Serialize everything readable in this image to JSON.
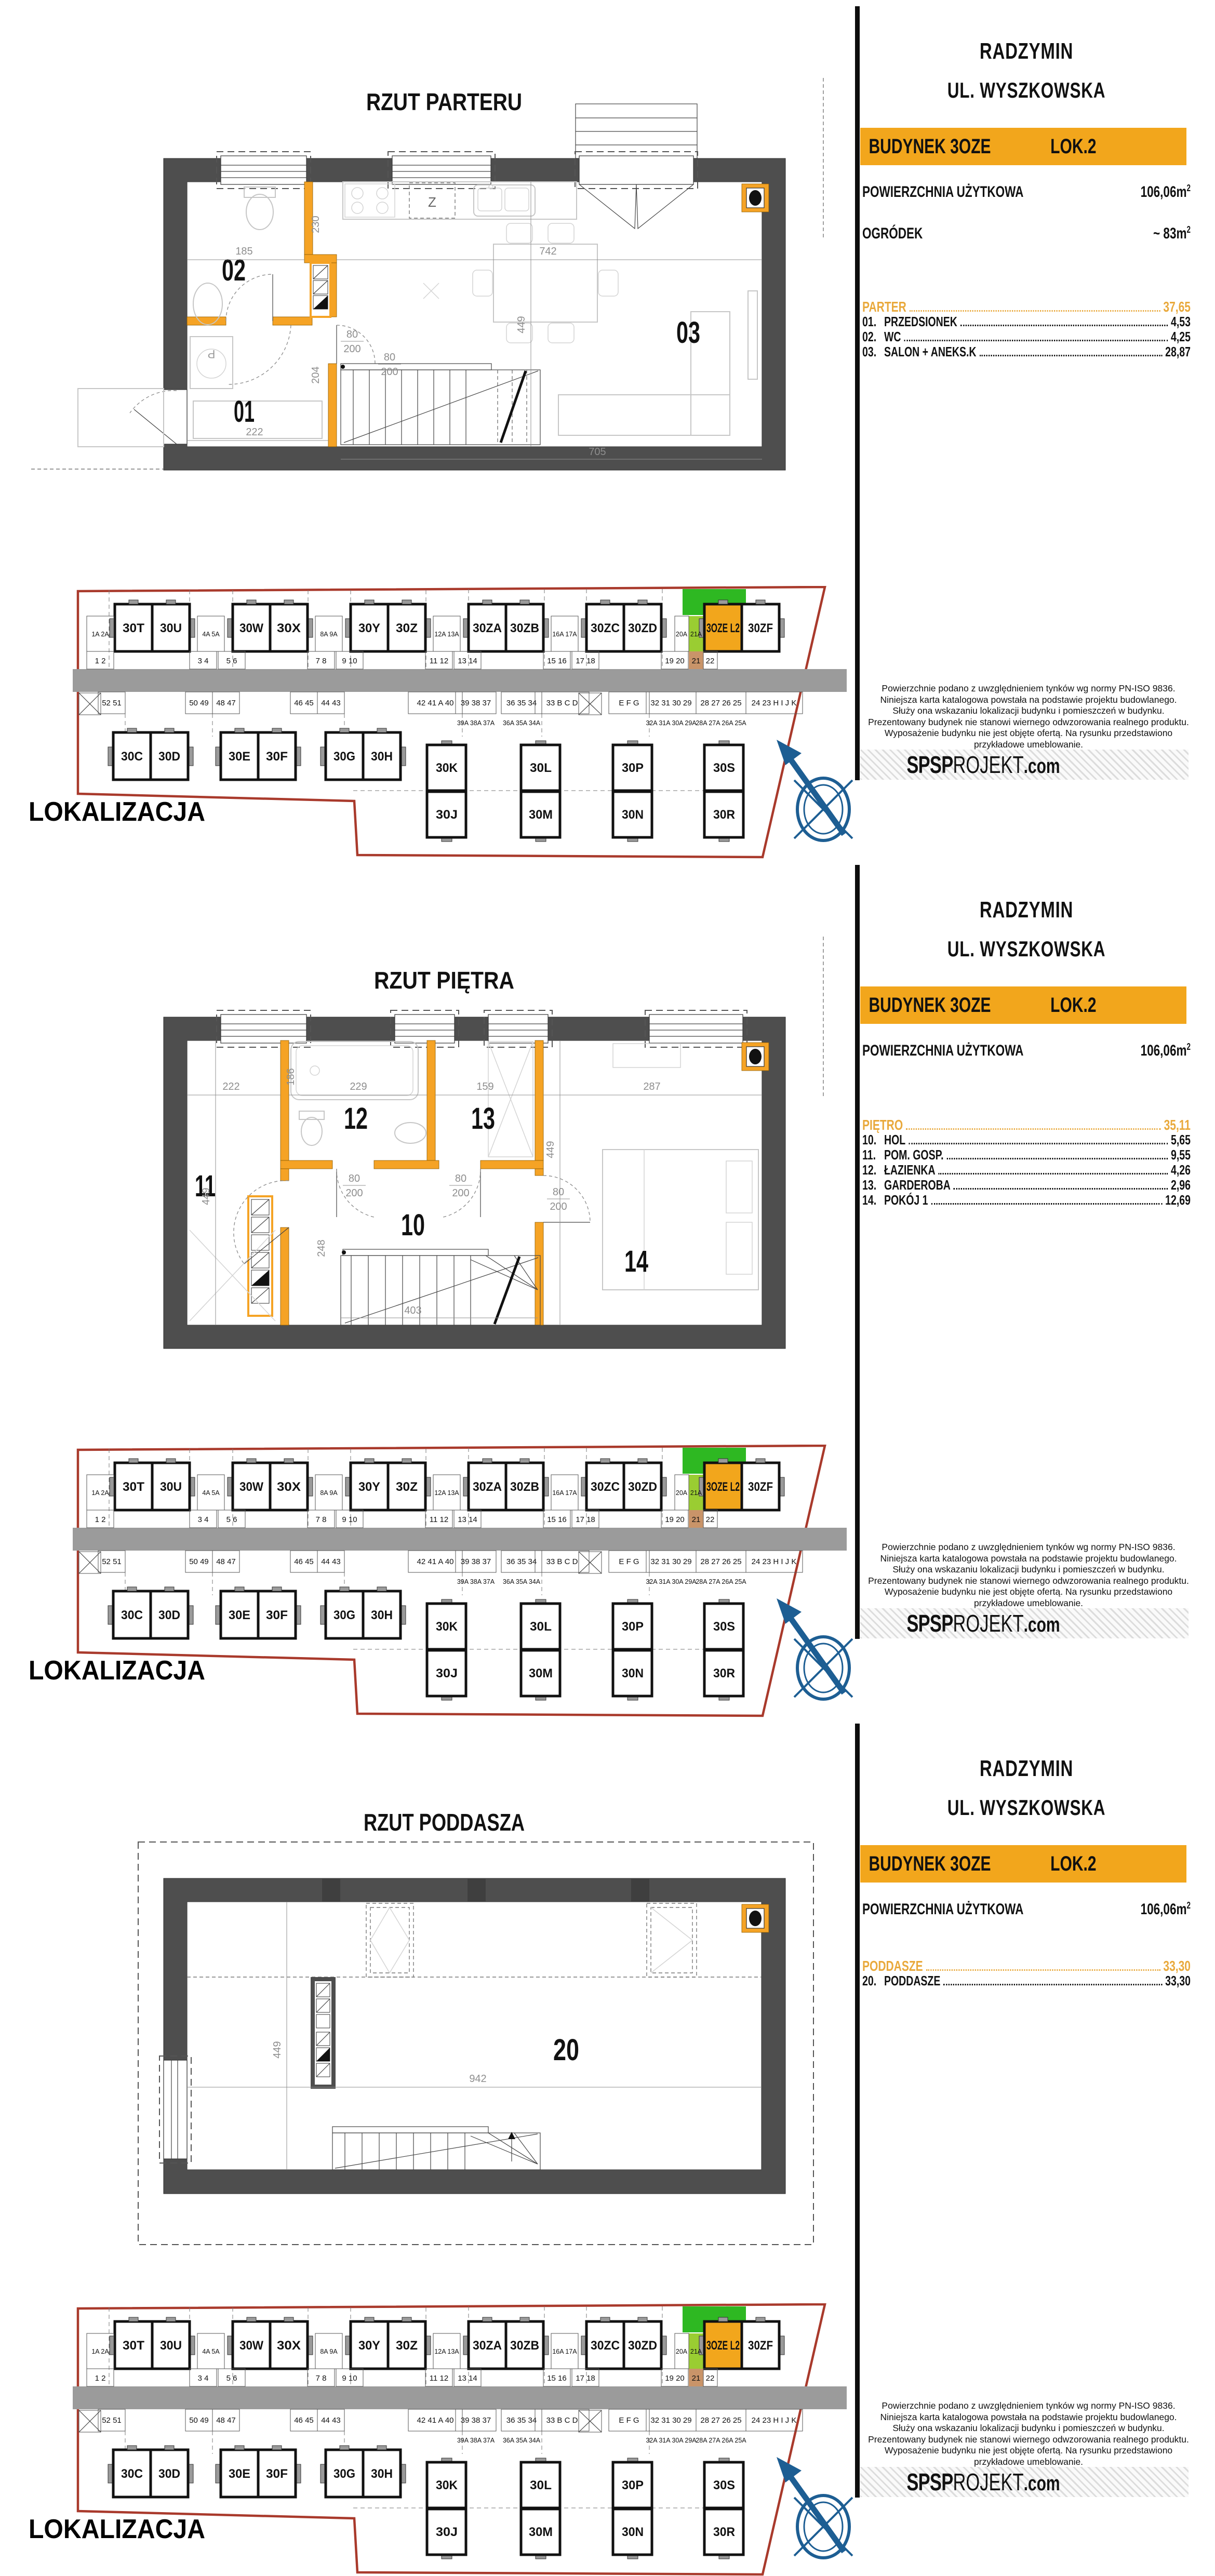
{
  "sidebar": {
    "city": "RADZYMIN",
    "street": "UL. WYSZKOWSKA",
    "building": "BUDYNEK 3OZE",
    "unit": "LOK.2",
    "area_label": "POWIERZCHNIA UŻYTKOWA",
    "area_value": "106,06m",
    "area_sup": "2",
    "garden_label": "OGRÓDEK",
    "garden_value": "~ 83m",
    "garden_sup": "2",
    "disclaimer": [
      "Powierzchnie podano z uwzględnieniem tynków wg normy PN-ISO 9836.",
      "Niniejsza karta katalogowa powstała na podstawie projektu budowlanego.",
      "Służy ona wskazaniu lokalizacji budynku i pomieszczeń w budynku.",
      "Prezentowany budynek nie stanowi wiernego odwzorowania realnego produktu.",
      "Wyposażenie budynku nie jest objęte ofertą. Na rysunku przedstawiono",
      "przykładowe umeblowanie."
    ],
    "logo_bold": "SPSP",
    "logo_light": "ROJEKT",
    "logo_suffix": ".com"
  },
  "panels": [
    {
      "plan_title": "RZUT PARTERU",
      "floor_label": "PARTER",
      "floor_total": "37,65",
      "rooms": [
        {
          "num": "01.",
          "name": "PRZEDSIONEK",
          "area": "4,53"
        },
        {
          "num": "02.",
          "name": "WC",
          "area": "4,25"
        },
        {
          "num": "03.",
          "name": "SALON + ANEKS.K",
          "area": "28,87"
        }
      ],
      "labels": {
        "a": "01",
        "b": "02",
        "c": "03"
      },
      "dims": {
        "w185": "185",
        "w230": "230",
        "w742": "742",
        "w449": "449",
        "w204": "204",
        "w222": "222",
        "w705": "705",
        "dw": "80",
        "dh": "200"
      },
      "glyphs": {
        "z": "Z",
        "p": "P"
      }
    },
    {
      "plan_title": "RZUT PIĘTRA",
      "floor_label": "PIĘTRO",
      "floor_total": "35,11",
      "rooms": [
        {
          "num": "10.",
          "name": "HOL",
          "area": "5,65"
        },
        {
          "num": "11.",
          "name": "POM. GOSP.",
          "area": "9,55"
        },
        {
          "num": "12.",
          "name": "ŁAZIENKA",
          "area": "4,26"
        },
        {
          "num": "13.",
          "name": "GARDEROBA",
          "area": "2,96"
        },
        {
          "num": "14.",
          "name": "POKÓJ 1",
          "area": "12,69"
        }
      ],
      "labels": {
        "a": "10",
        "b": "11",
        "c": "12",
        "d": "13",
        "e": "14"
      },
      "dims": {
        "w222": "222",
        "w186": "186",
        "w229": "229",
        "w159": "159",
        "w287": "287",
        "w449": "449",
        "w449b": "449",
        "w248": "248",
        "w403": "403",
        "dw": "80",
        "dh": "200"
      }
    },
    {
      "plan_title": "RZUT PODDASZA",
      "floor_label": "PODDASZE",
      "floor_total": "33,30",
      "rooms": [
        {
          "num": "20.",
          "name": "PODDASZE",
          "area": "33,30"
        }
      ],
      "labels": {
        "a": "20"
      },
      "dims": {
        "w449": "449",
        "w942": "942"
      }
    }
  ],
  "location": {
    "label": "LOKALIZACJA",
    "top": [
      "30T",
      "30U",
      "30W",
      "30X",
      "30Y",
      "30Z",
      "30ZA",
      "30ZB",
      "30ZC",
      "30ZD"
    ],
    "highlight": "3OZE L2",
    "after_highlight": "30ZF",
    "bottom": [
      "30C",
      "30D",
      "30E",
      "30F",
      "30G",
      "30H"
    ],
    "vert": [
      "30K",
      "30J",
      "30L",
      "30M",
      "30P",
      "30N",
      "30S",
      "30R"
    ],
    "sua": [
      "1A 2A",
      "4A 5A",
      "8A 9A",
      "12A 13A",
      "16A 17A",
      "20A",
      "21A"
    ],
    "su": [
      "1 2",
      "3 4",
      "5 6",
      "7 8",
      "9 10",
      "11 12",
      "13 14",
      "15 16",
      "17 18",
      "19 20",
      "21",
      "22"
    ],
    "sl": [
      "52 51",
      "50 49",
      "48 47",
      "46 45",
      "44 43",
      "42 41 A 40",
      "39 38 37",
      "36 35 34",
      "33 B C D",
      "E F G",
      "32 31 30 29",
      "28 27 26 25",
      "24 23 H I J K"
    ],
    "sla": [
      "39A 38A 37A",
      "36A 35A 34A",
      "32A 31A 30A 29A",
      "28A 27A 26A 25A"
    ]
  }
}
